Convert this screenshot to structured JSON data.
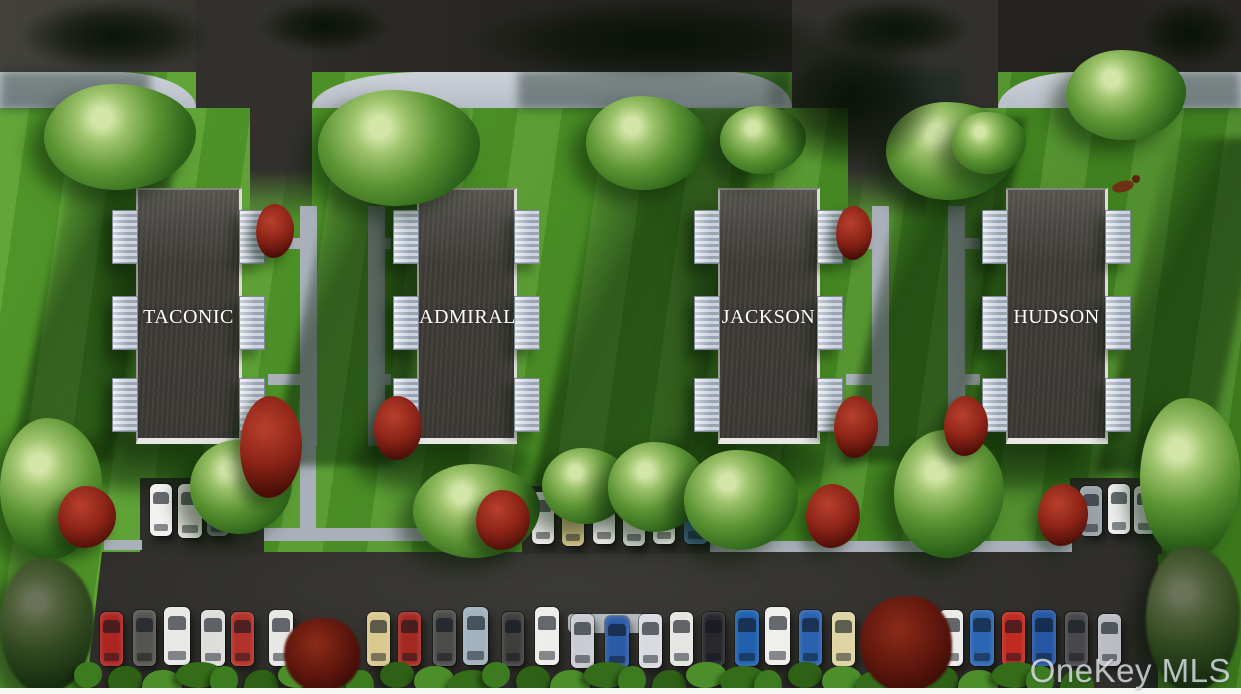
{
  "watermark": "OneKey MLS",
  "palette": {
    "grass1": "#58a12d",
    "grass2": "#4c9226",
    "grass3": "#3f7f1e",
    "road": "#2c2a26",
    "asphalt": "#31302c",
    "lot": "#2f2e2a",
    "sidewalk": "#cdd2d9",
    "sidewalk2": "#b8bec7",
    "walk": "#a9b0b9",
    "roof": "#45423d",
    "roof-edge": "#e8e8e6",
    "porch-light": "#e7ecf3",
    "porch-dark": "#a7b1c1",
    "red-bush": "#8c2417",
    "white-strip": "#f6f6f4",
    "watermark": "#dfe5ea",
    "car-glass": "rgba(16,22,30,0.62)"
  },
  "buildings": [
    {
      "name": "TACONIC",
      "x": 136,
      "y": 188,
      "w": 106,
      "h": 256,
      "walk_side": "right",
      "walk_x": 300
    },
    {
      "name": "ADMIRAL",
      "x": 417,
      "y": 188,
      "w": 100,
      "h": 256,
      "walk_side": "left",
      "walk_x": 368
    },
    {
      "name": "JACKSON",
      "x": 718,
      "y": 188,
      "w": 102,
      "h": 256,
      "walk_side": "right",
      "walk_x": 872
    },
    {
      "name": "HUDSON",
      "x": 1006,
      "y": 188,
      "w": 102,
      "h": 256,
      "walk_side": "left",
      "walk_x": 948
    }
  ],
  "parking": {
    "bays": [
      [
        140,
        478,
        124,
        76
      ],
      [
        522,
        486,
        188,
        68
      ],
      [
        1070,
        478,
        92,
        76
      ]
    ],
    "walkways": [
      [
        104,
        540,
        38,
        10
      ],
      [
        264,
        528,
        258,
        13
      ],
      [
        710,
        541,
        362,
        11
      ],
      [
        300,
        446,
        16,
        86
      ]
    ],
    "island": [
      568,
      614,
      94,
      19
    ],
    "cars": [
      [
        150,
        484,
        22,
        52,
        "#f2f2f0"
      ],
      [
        178,
        484,
        24,
        54,
        "#eceae6"
      ],
      [
        207,
        486,
        22,
        50,
        "#70767a"
      ],
      [
        532,
        492,
        22,
        52,
        "#eeeeec"
      ],
      [
        562,
        494,
        22,
        52,
        "#d5c386"
      ],
      [
        593,
        492,
        22,
        52,
        "#f0f0ee"
      ],
      [
        623,
        494,
        22,
        52,
        "#e9e9e7"
      ],
      [
        653,
        492,
        22,
        52,
        "#f1f1ef"
      ],
      [
        684,
        490,
        24,
        54,
        "#3f6f9e"
      ],
      [
        1080,
        486,
        22,
        50,
        "#9aa1a7"
      ],
      [
        1108,
        484,
        22,
        50,
        "#eef0f0"
      ],
      [
        1134,
        486,
        22,
        48,
        "#e6e8e8"
      ],
      [
        100,
        612,
        23,
        54,
        "#ad2520"
      ],
      [
        133,
        610,
        23,
        56,
        "#56544f"
      ],
      [
        164,
        607,
        26,
        58,
        "#e9e9e7"
      ],
      [
        201,
        610,
        24,
        56,
        "#dddddb"
      ],
      [
        231,
        612,
        23,
        54,
        "#b23129"
      ],
      [
        269,
        610,
        24,
        56,
        "#e7e7e5"
      ],
      [
        367,
        612,
        23,
        54,
        "#d9c98e"
      ],
      [
        398,
        612,
        23,
        54,
        "#a42a21"
      ],
      [
        433,
        610,
        23,
        56,
        "#4b4b49"
      ],
      [
        463,
        607,
        25,
        58,
        "#a2b2be"
      ],
      [
        502,
        612,
        22,
        54,
        "#3e3e3c"
      ],
      [
        535,
        607,
        24,
        58,
        "#ededeb"
      ],
      [
        571,
        614,
        23,
        54,
        "#c9ccd0"
      ],
      [
        605,
        616,
        24,
        52,
        "#2b5ba6"
      ],
      [
        639,
        614,
        23,
        54,
        "#d9dbe0"
      ],
      [
        670,
        612,
        23,
        54,
        "#e5e5e3"
      ],
      [
        702,
        612,
        23,
        54,
        "#28282c"
      ],
      [
        735,
        610,
        24,
        56,
        "#2060ae"
      ],
      [
        765,
        607,
        25,
        58,
        "#efefed"
      ],
      [
        799,
        610,
        23,
        56,
        "#2a62b0"
      ],
      [
        832,
        612,
        23,
        54,
        "#ded4a4"
      ],
      [
        939,
        610,
        24,
        56,
        "#eaeae8"
      ],
      [
        970,
        610,
        24,
        56,
        "#2c66b2"
      ],
      [
        1002,
        612,
        23,
        54,
        "#c02a20"
      ],
      [
        1032,
        610,
        24,
        56,
        "#2456a4"
      ],
      [
        1065,
        612,
        23,
        54,
        "#48484c"
      ],
      [
        1098,
        614,
        23,
        52,
        "#babdc2"
      ]
    ]
  },
  "landscape": {
    "trees": [
      [
        44,
        84,
        152,
        106,
        0
      ],
      [
        318,
        90,
        162,
        116,
        0
      ],
      [
        586,
        96,
        120,
        94,
        0
      ],
      [
        720,
        106,
        86,
        68,
        0
      ],
      [
        886,
        102,
        130,
        98,
        0
      ],
      [
        952,
        112,
        74,
        62,
        0
      ],
      [
        1066,
        50,
        120,
        90,
        0
      ],
      [
        0,
        418,
        102,
        142,
        0
      ],
      [
        190,
        440,
        102,
        94,
        0
      ],
      [
        413,
        464,
        127,
        94,
        0
      ],
      [
        542,
        448,
        88,
        76,
        0
      ],
      [
        608,
        442,
        98,
        90,
        0
      ],
      [
        684,
        450,
        114,
        100,
        0
      ],
      [
        894,
        430,
        110,
        128,
        0
      ],
      [
        1140,
        398,
        100,
        162,
        0
      ],
      [
        1146,
        546,
        94,
        146,
        1
      ],
      [
        0,
        558,
        94,
        136,
        1
      ]
    ],
    "canopies": [
      [
        20,
        0,
        190,
        72
      ],
      [
        260,
        0,
        130,
        52
      ],
      [
        470,
        0,
        370,
        80
      ],
      [
        760,
        30,
        180,
        140
      ],
      [
        820,
        0,
        150,
        58
      ],
      [
        1140,
        0,
        101,
        66
      ]
    ],
    "red_bushes": [
      [
        256,
        204,
        38,
        54
      ],
      [
        240,
        396,
        62,
        102
      ],
      [
        58,
        486,
        58,
        62
      ],
      [
        374,
        396,
        48,
        64
      ],
      [
        476,
        490,
        54,
        60
      ],
      [
        836,
        206,
        36,
        54
      ],
      [
        834,
        396,
        44,
        62
      ],
      [
        806,
        484,
        54,
        64
      ],
      [
        944,
        396,
        44,
        60
      ],
      [
        1038,
        484,
        50,
        62
      ]
    ],
    "red_trees": [
      [
        284,
        618,
        76,
        74
      ],
      [
        860,
        596,
        92,
        96
      ]
    ],
    "shadow_bands": [
      [
        46,
        118,
        102,
        344
      ],
      [
        308,
        112,
        120,
        354
      ],
      [
        572,
        108,
        152,
        384
      ],
      [
        878,
        118,
        112,
        344
      ],
      [
        1132,
        138,
        108,
        334
      ]
    ],
    "sidewalk_shadows": [
      [
        0,
        70,
        150,
        40
      ],
      [
        518,
        70,
        268,
        40
      ],
      [
        842,
        70,
        120,
        38
      ],
      [
        1174,
        70,
        67,
        40
      ]
    ],
    "hedge": {
      "x0": 74,
      "x1": 1062,
      "step": 34,
      "y": 662,
      "colors": [
        "#3d7b20",
        "#2e6015",
        "#4c8f2a",
        "#356c1a"
      ]
    },
    "deer": {
      "x": 1108,
      "y": 172
    }
  }
}
